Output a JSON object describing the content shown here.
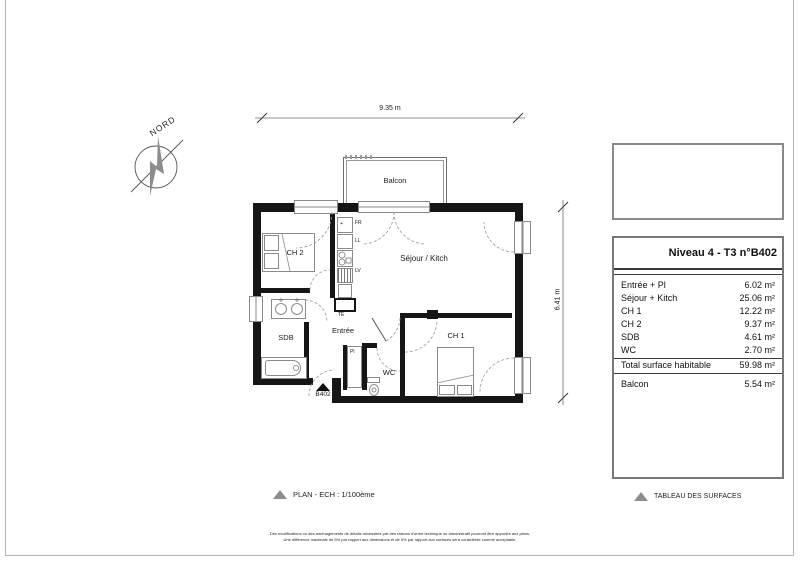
{
  "compass": {
    "label": "NORD"
  },
  "dims": {
    "width_label": "9.35 m",
    "height_label": "6.41 m"
  },
  "plan": {
    "balcony": "Balcon",
    "ch2": "CH 2",
    "sdb": "SDB",
    "entree": "Entrée",
    "sejour": "Séjour / Kitch",
    "ch1": "CH 1",
    "wc": "WC",
    "pl": "Pl",
    "door_tag": "B402",
    "appliances": {
      "fr": "FR",
      "ll": "LL",
      "lv": "LV",
      "te": "TE",
      "fr_mark": "+"
    }
  },
  "legends": {
    "plan": "PLAN - ECH : 1/100ème",
    "table": "TABLEAU DES SURFACES"
  },
  "surface_table": {
    "title": "Niveau 4 - T3 n°B402",
    "rows": [
      {
        "label": "Entrée + Pl",
        "value": "6.02 m²"
      },
      {
        "label": "Séjour + Kitch",
        "value": "25.06 m²"
      },
      {
        "label": "CH 1",
        "value": "12.22 m²"
      },
      {
        "label": "CH 2",
        "value": "9.37 m²"
      },
      {
        "label": "SDB",
        "value": "4.61 m²"
      },
      {
        "label": "WC",
        "value": "2.70 m²"
      }
    ],
    "total": {
      "label": "Total surface habitable",
      "value": "59.98 m²"
    },
    "balcony": {
      "label": "Balcon",
      "value": "5.54 m²"
    }
  },
  "disclaimer": {
    "line1": "Des modifications ou des aménagements de détails nécessités par des raisons d'ordre technique ou administratif pourront être apportés aux plans.",
    "line2": "Une différence maximale de 5% par rapport aux dimensions et de 5% par rapport aux surfaces sera considérée comme acceptable."
  }
}
